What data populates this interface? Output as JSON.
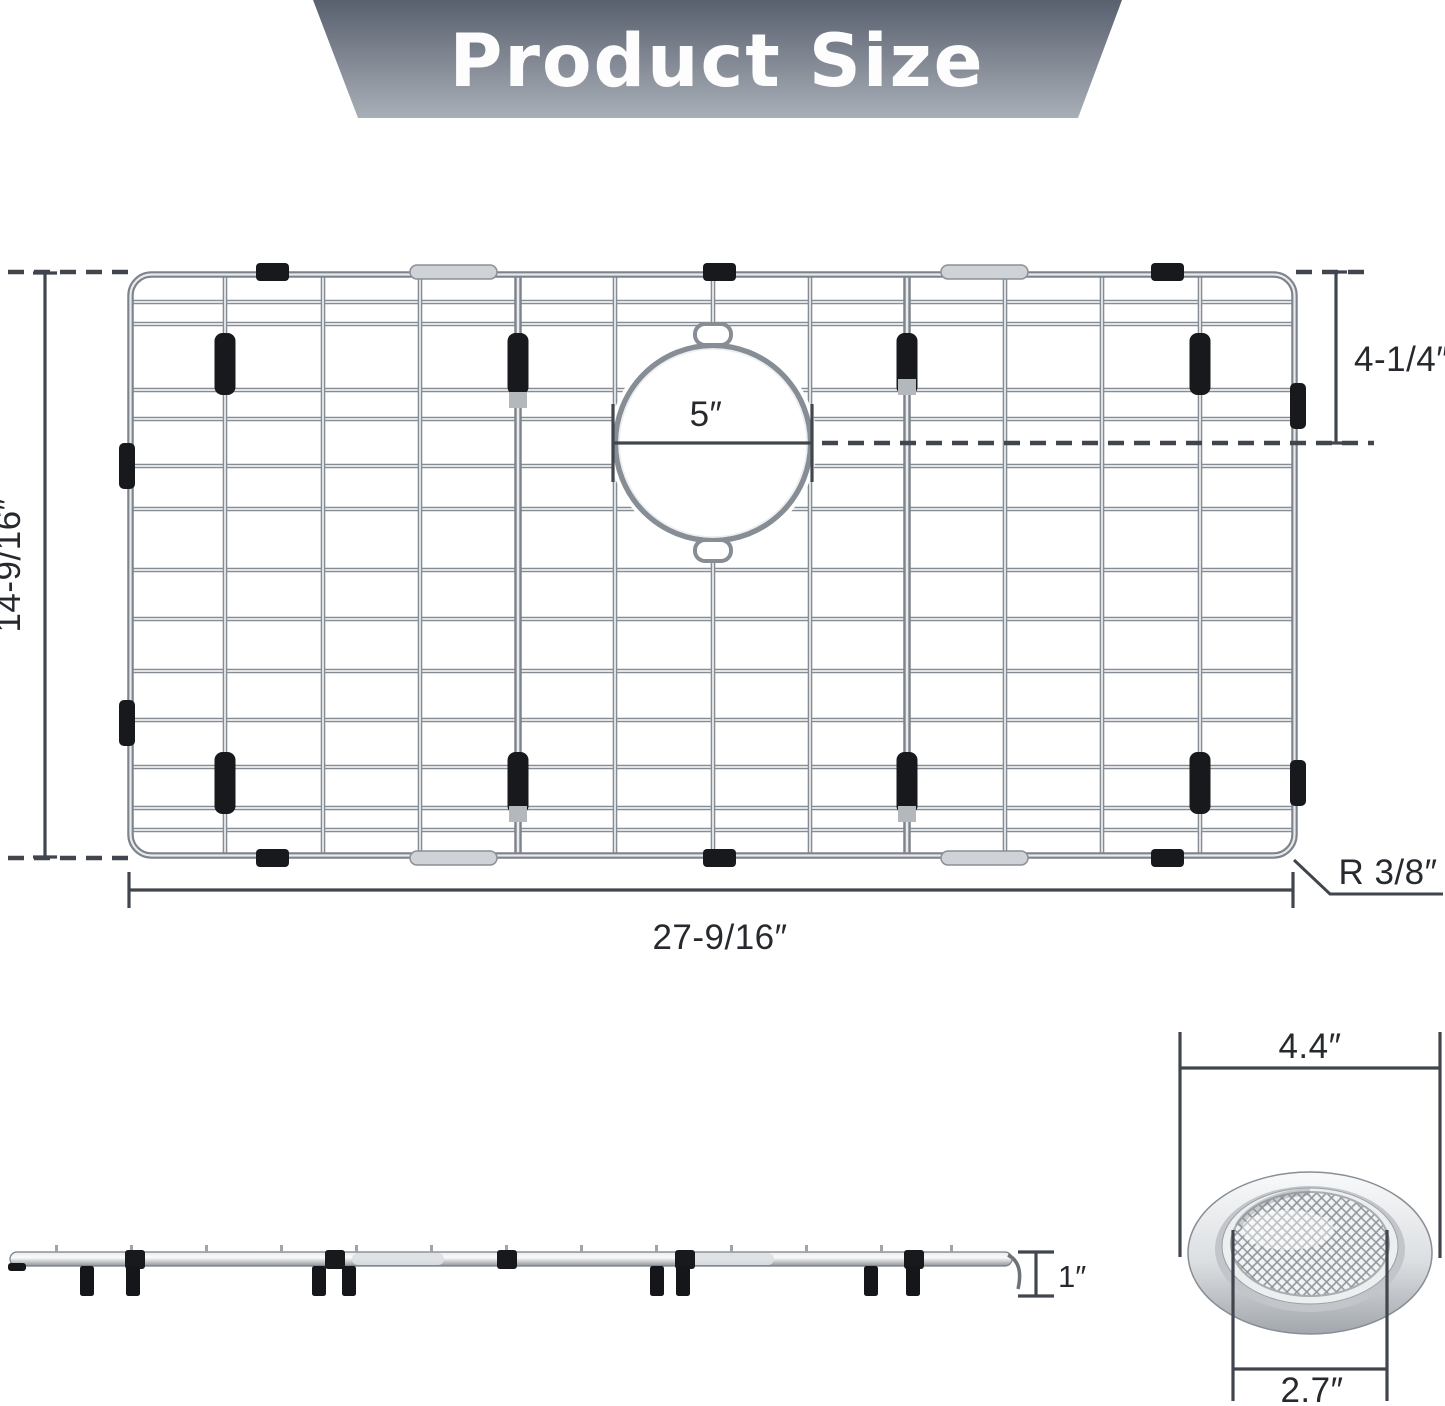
{
  "banner": {
    "title": "Product Size"
  },
  "top_view": {
    "height_label": "14-9/16″",
    "width_label": "27-9/16″",
    "hole_diameter_label": "5″",
    "hole_offset_label": "4-1/4″",
    "corner_radius_label": "R 3/8″"
  },
  "side_view": {
    "thickness_label": "1″"
  },
  "strainer": {
    "outer_width_label": "4.4″",
    "inner_width_label": "2.7″"
  },
  "colors": {
    "banner_top": "#59606e",
    "banner_bottom": "#a9afb7",
    "wire_dark": "#868c93",
    "wire_light": "#eef0f2",
    "clip_black": "#17191d",
    "dimension_line": "#41464e",
    "label_text": "#26292e"
  }
}
